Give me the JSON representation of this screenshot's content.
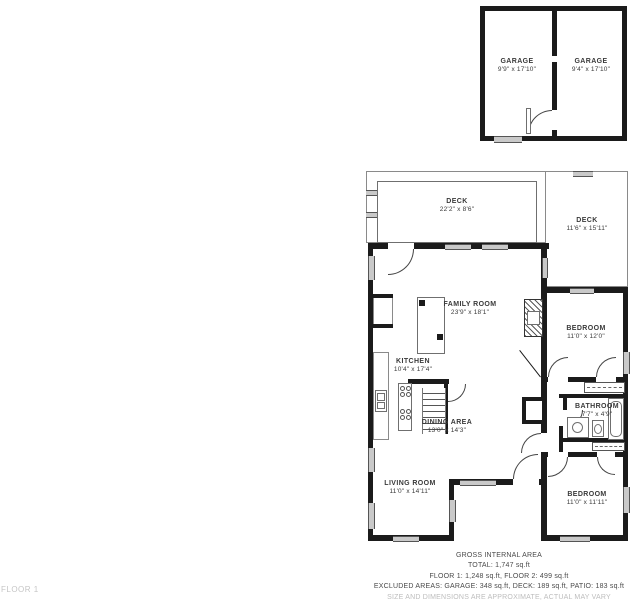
{
  "floor_label": "FLOOR 1",
  "garage": {
    "left": {
      "name": "GARAGE",
      "dims": "9'9\" x 17'10\""
    },
    "right": {
      "name": "GARAGE",
      "dims": "9'4\" x 17'10\""
    }
  },
  "rooms": {
    "deck_top": {
      "name": "DECK",
      "dims": "22'2\" x 8'6\""
    },
    "deck_right": {
      "name": "DECK",
      "dims": "11'6\" x 15'11\""
    },
    "family": {
      "name": "FAMILY ROOM",
      "dims": "23'9\" x 18'1\""
    },
    "kitchen": {
      "name": "KITCHEN",
      "dims": "10'4\" x 17'4\""
    },
    "bedroom1": {
      "name": "BEDROOM",
      "dims": "11'0\" x 12'0\""
    },
    "bathroom": {
      "name": "BATHROOM",
      "dims": "7'7\" x 4'9\""
    },
    "dining": {
      "name": "DINING AREA",
      "dims": "13'0\" x 14'3\""
    },
    "living": {
      "name": "LIVING ROOM",
      "dims": "11'0\" x 14'11\""
    },
    "bedroom2": {
      "name": "BEDROOM",
      "dims": "11'0\" x 11'11\""
    }
  },
  "summary": {
    "title": "GROSS INTERNAL AREA",
    "total": "TOTAL: 1,747 sq.ft",
    "floors": "FLOOR 1: 1,248 sq.ft, FLOOR 2: 499 sq.ft",
    "excluded": "EXCLUDED AREAS: GARAGE: 348 sq.ft, DECK: 189 sq.ft, PATIO: 183 sq.ft",
    "disclaimer": "SIZE AND DIMENSIONS ARE APPROXIMATE, ACTUAL MAY VARY"
  },
  "colors": {
    "wall": "#1b1b1b",
    "window": "#c9c9c9",
    "label": "#3a3a3a",
    "muted": "#bdbdbd"
  }
}
